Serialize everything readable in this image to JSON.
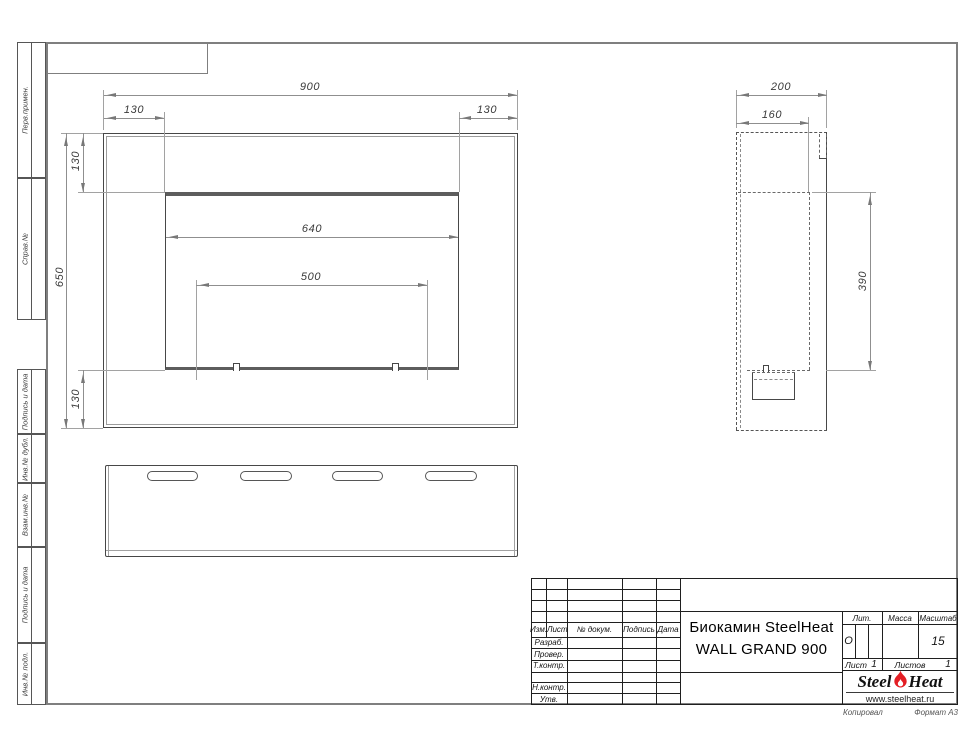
{
  "margin_labels": [
    "Перв.примен.",
    "Справ.№",
    "Подпись и дата",
    "Инв.№ дубл.",
    "Взам.инв.№",
    "Подпись и дата",
    "Инв.№ подл."
  ],
  "drawing": {
    "front_view": {
      "overall_width": "900",
      "margin_left": "130",
      "margin_right": "130",
      "margin_top": "130",
      "overall_height": "650",
      "margin_bottom": "130",
      "opening_width": "640",
      "burner_width": "500"
    },
    "side_view": {
      "depth": "200",
      "inner_depth": "160",
      "opening_height": "390"
    }
  },
  "title_block": {
    "columns": {
      "izm": "Изм.",
      "list": "Лист",
      "doc": "№ докум.",
      "sign": "Подпись",
      "date": "Дата"
    },
    "rows": {
      "developed": "Разраб.",
      "checked": "Провер.",
      "tcontrol": "Т.контр.",
      "ncontrol": "Н.контр.",
      "approved": "Утв."
    },
    "title_line1": "Биокамин SteelHeat",
    "title_line2": "WALL GRAND 900",
    "lit_label": "Лит.",
    "lit_value": "О",
    "mass_label": "Масса",
    "scale_label": "Масштаб",
    "scale_value": "15",
    "sheet_label": "Лист",
    "sheet_value": "1",
    "sheets_label": "Листов",
    "sheets_value": "1",
    "logo": {
      "part1": "Steel",
      "part2": "Heat",
      "url": "www.steelheat.ru",
      "flame_color": "#e31e24"
    }
  },
  "footer": {
    "copied": "Копировал",
    "format": "Формат А3"
  }
}
